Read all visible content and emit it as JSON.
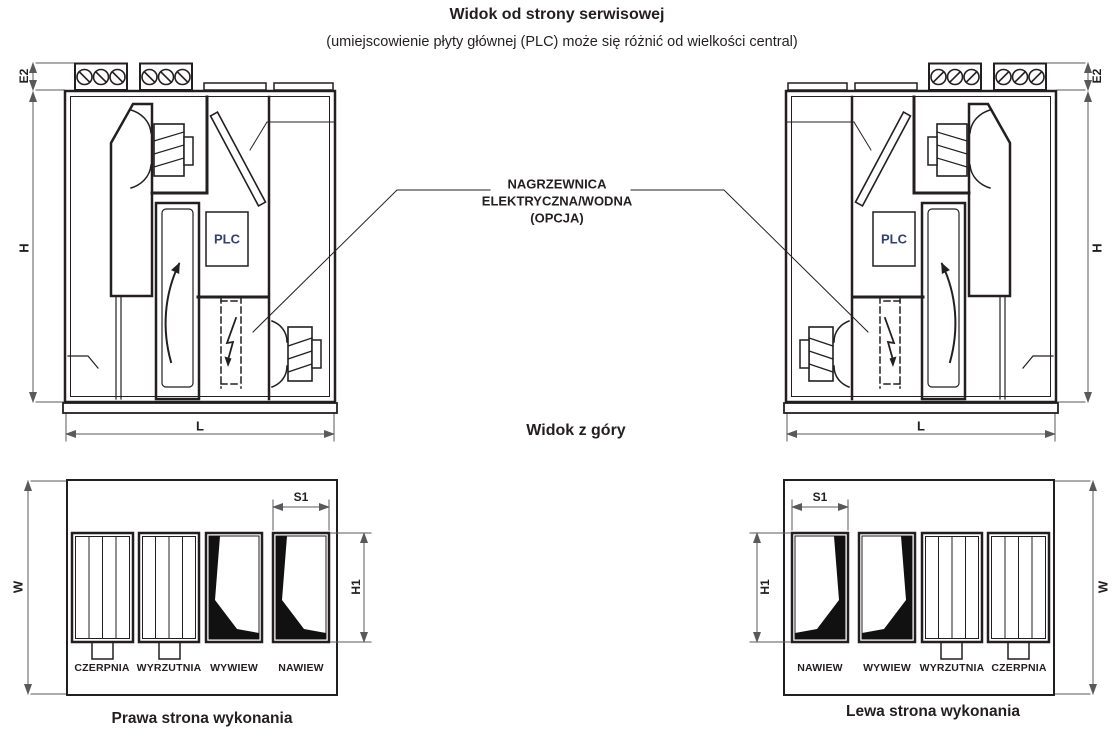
{
  "header": {
    "title": "Widok od strony serwisowej",
    "subtitle": "(umiejscowienie płyty głównej (PLC) może się różnić od wielkości central)"
  },
  "callout": {
    "line1": "NAGRZEWNICA",
    "line2": "ELEKTRYCZNA/WODNA",
    "line3": "(OPCJA)"
  },
  "service_view": {
    "plc_label": "PLC",
    "dim_E2": "E2",
    "dim_H": "H",
    "dim_L": "L"
  },
  "top_view": {
    "heading": "Widok z góry",
    "dim_W": "W",
    "dim_S1": "S1",
    "dim_H1": "H1",
    "left_ports": [
      "CZERPNIA",
      "WYRZUTNIA",
      "WYWIEW",
      "NAWIEW"
    ],
    "right_ports": [
      "NAWIEW",
      "WYWIEW",
      "WYRZUTNIA",
      "CZERPNIA"
    ],
    "left_caption": "Prawa strona wykonania",
    "right_caption": "Lewa strona wykonania"
  },
  "colors": {
    "line": "#231f20",
    "dimension": "#58595b",
    "plc_text": "#33406e",
    "background": "#ffffff"
  }
}
